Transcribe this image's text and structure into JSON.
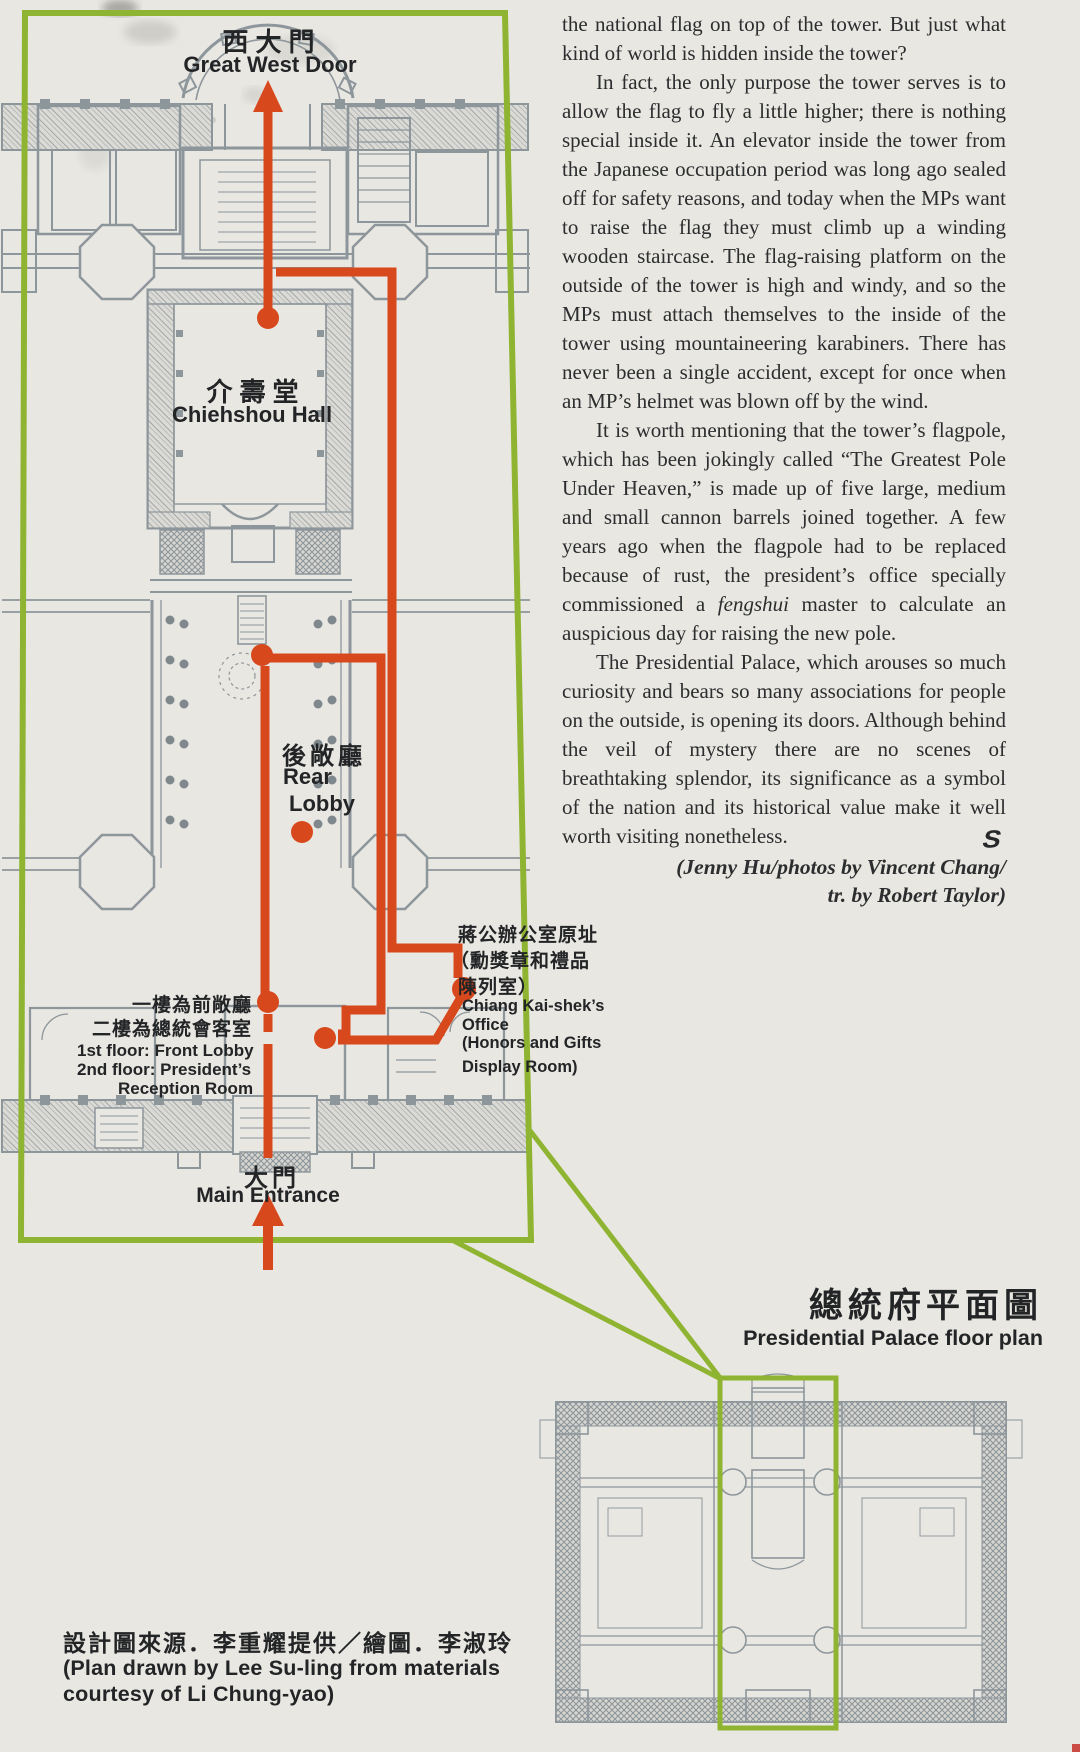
{
  "colors": {
    "page_background": "#e9e7e2",
    "accent_green": "#8fb431",
    "route_red": "#d8481d",
    "plan_gray": "#8d969b",
    "text": "#2b2d2e"
  },
  "article": {
    "p1": "the national flag on top of the tower. But just what kind of world is hidden inside the tower?",
    "p2": "In fact, the only purpose the tower serves is to allow the flag to fly a little higher; there is nothing special inside it. An elevator inside the tower from the Japanese occupation period was long ago sealed off for safety reasons, and today when the MPs want to raise the flag they must climb up a winding wooden staircase. The flag-raising platform on the outside of the tower is high and windy, and so the MPs must attach themselves to the inside of the tower using mountaineering karabiners. There has never been a single accident, except for once when an MP’s helmet was blown off by the wind.",
    "p3a": "It is worth mentioning that the tower’s flagpole, which has been jokingly called “The Greatest Pole Under Heaven,” is made up of five large, medium and small cannon barrels joined together. A few years ago when the flagpole had to be replaced because of rust, the president’s office specially commissioned a ",
    "p3_italic": "fengshui",
    "p3b": " master to calculate an auspicious day for raising the new pole.",
    "p4": "The Presidential Palace, which arouses so much curiosity and bears so many associations for people on the outside, is opening its doors. Although behind the veil of mystery there are no scenes of breathtaking splendor, its significance as a symbol of the nation and its historical value make it well worth visiting nonetheless.",
    "credit1": "(Jenny Hu/photos by Vincent Chang/",
    "credit2": "tr. by Robert Taylor)",
    "end_mark": "S"
  },
  "plan": {
    "west_door_zh": "西大門",
    "west_door_en": "Great West Door",
    "hall_zh": "介壽堂",
    "hall_en": "Chiehshou Hall",
    "rear_zh": "後敞廳",
    "rear_en1": "Rear",
    "rear_en2": "Lobby",
    "front1_zh": "一樓為前敞廳",
    "front2_zh": "二樓為總統會客室",
    "front_en1": "1st floor: Front Lobby",
    "front_en2": "2nd floor: President’s",
    "front_en3": "Reception Room",
    "office_zh1": "蔣公辦公室原址",
    "office_zh2": "（勳獎章和禮品",
    "office_zh3": "陳列室）",
    "office_en1": "Chiang Kai-shek’s",
    "office_en2": "Office",
    "office_en3": "(Honors and Gifts",
    "office_en4": "Display Room)",
    "entrance_zh": "大門",
    "entrance_en": "Main Entrance"
  },
  "overview": {
    "title_zh": "總統府平面圖",
    "title_en": "Presidential Palace floor plan"
  },
  "credit": {
    "zh": "設計圖來源．李重耀提供／繪圖．李淑玲",
    "en1": "(Plan drawn by Lee Su-ling from materials",
    "en2": "courtesy of Li Chung-yao)"
  }
}
